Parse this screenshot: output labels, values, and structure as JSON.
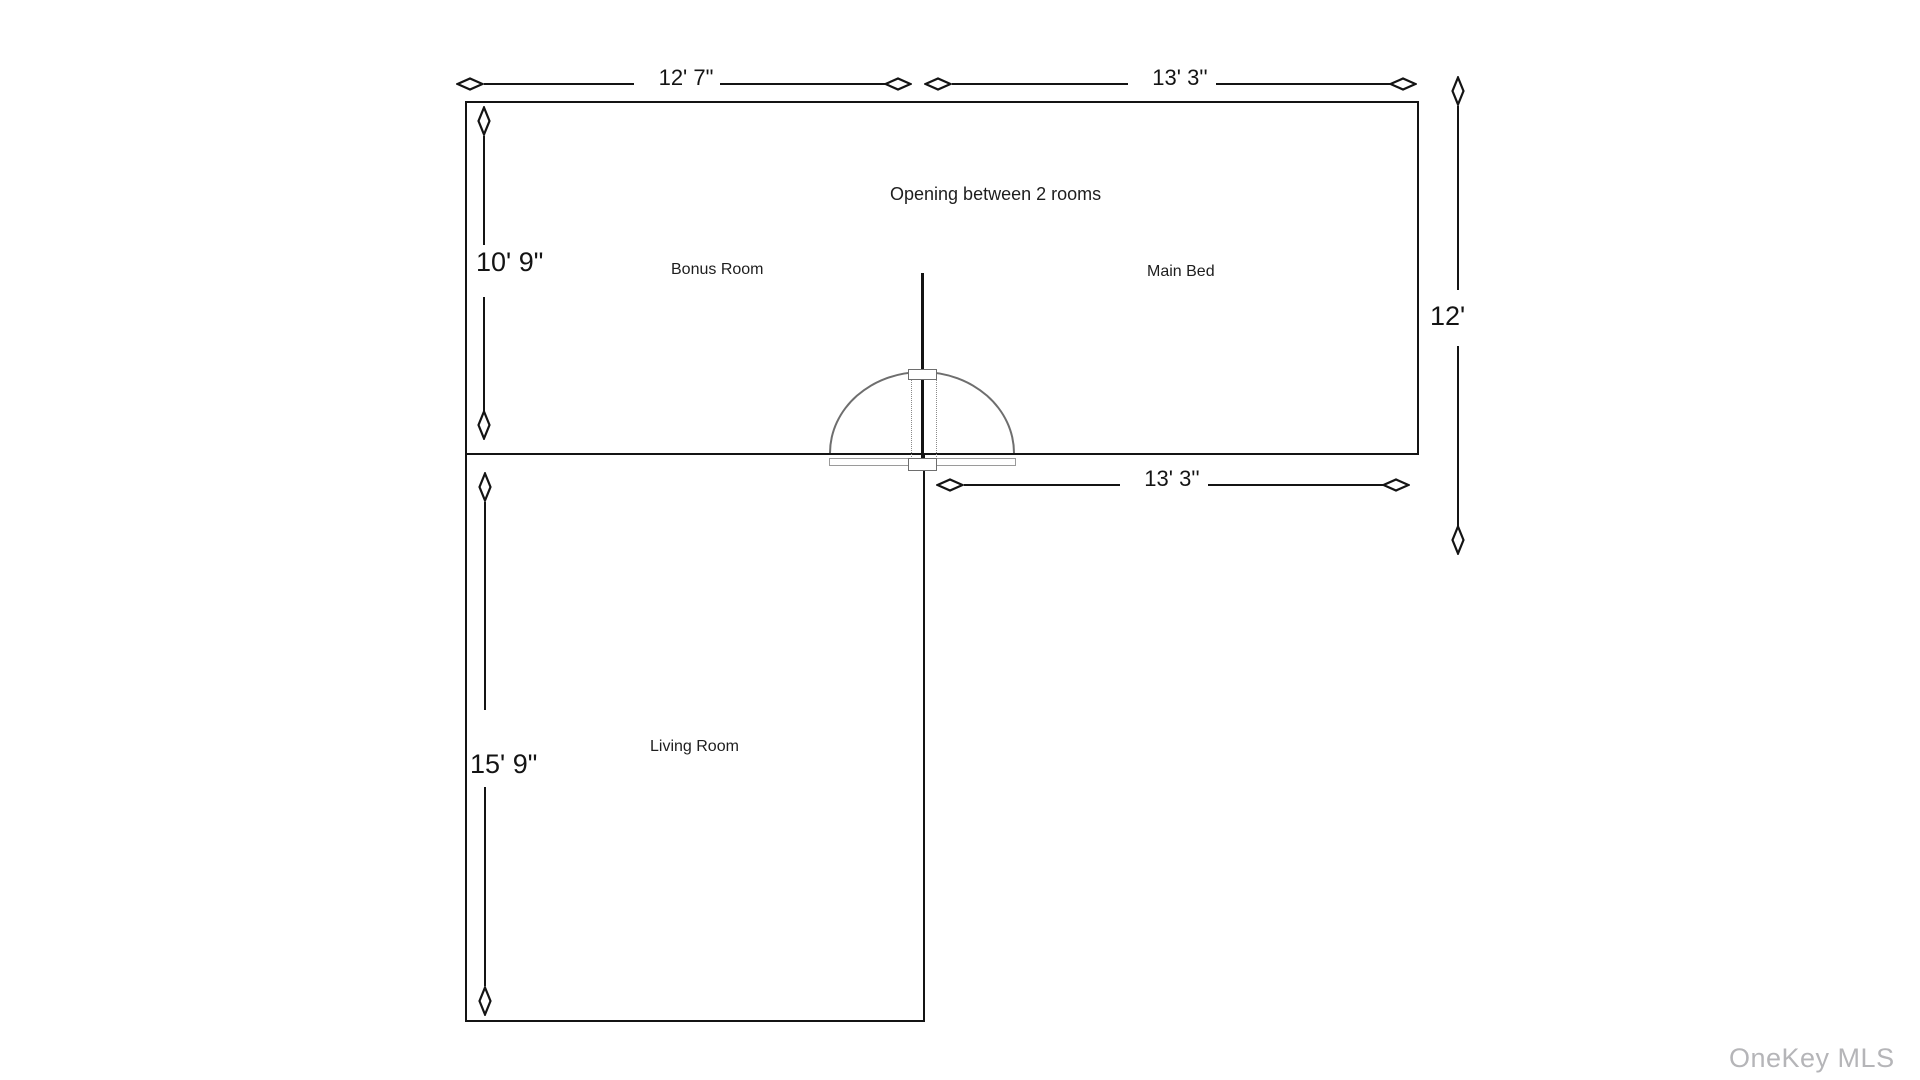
{
  "floorplan": {
    "dimensions": {
      "top_left": "12' 7\"",
      "top_right": "13' 3''",
      "middle": "13' 3''",
      "right_side": "12'",
      "left_upper": "10' 9\"",
      "left_lower": "15' 9\""
    },
    "rooms": {
      "bonus": "Bonus Room",
      "main_bed": "Main Bed",
      "living": "Living Room"
    },
    "annotation": "Opening between 2 rooms",
    "watermark": "OneKey MLS",
    "colors": {
      "wall": "#141414",
      "dimension_line": "#141414",
      "door_line": "#6e6e6e",
      "watermark": "#b5b5b8",
      "background": "#ffffff"
    }
  }
}
